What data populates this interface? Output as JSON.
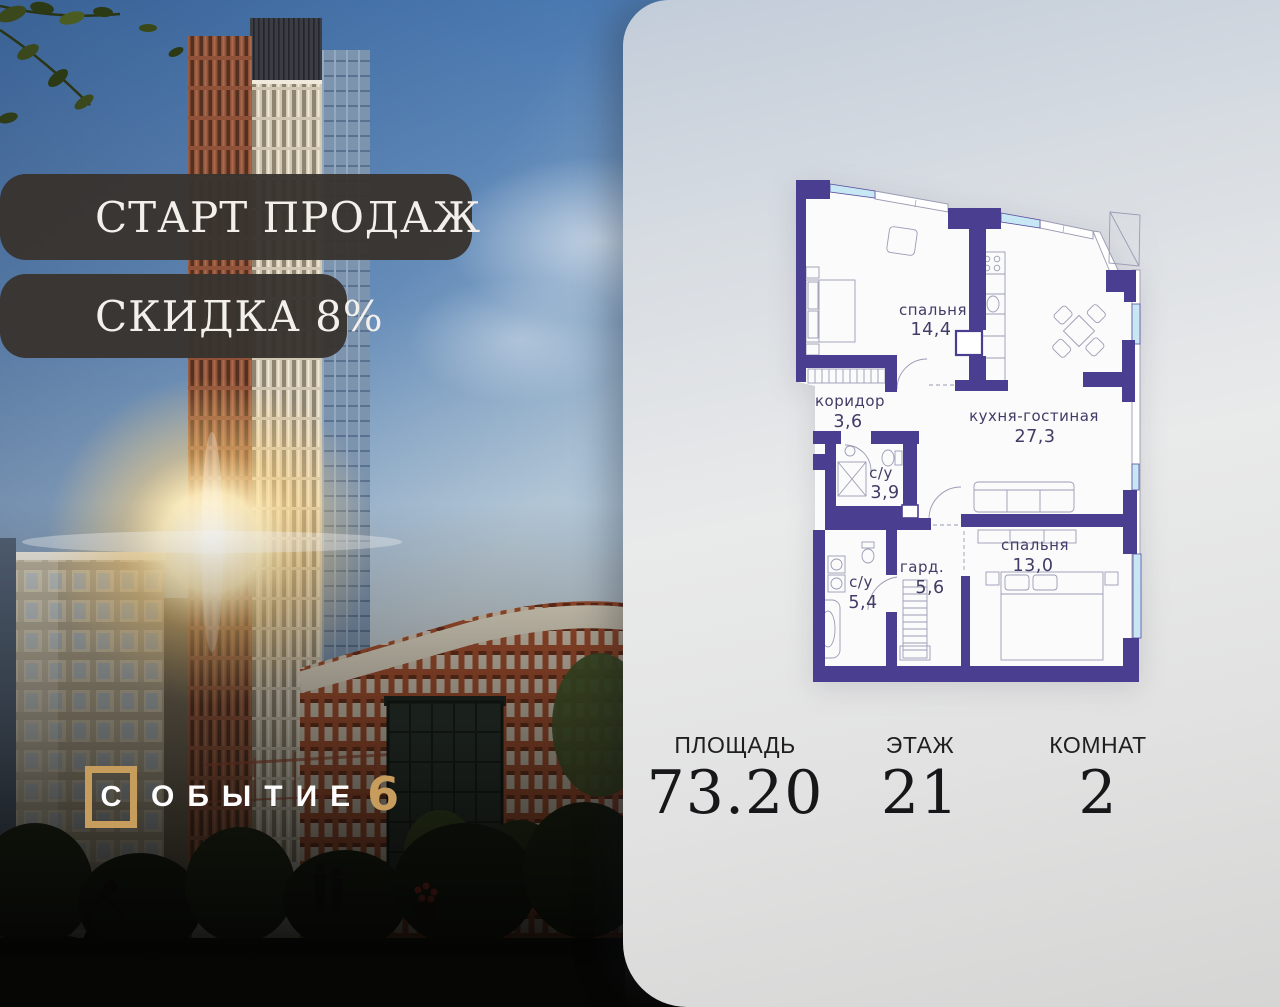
{
  "promo": {
    "banner1": "СТАРТ ПРОДАЖ",
    "banner2": "СКИДКА 8%"
  },
  "logo": {
    "letter_boxed": "С",
    "rest": "ОБЫТИЕ",
    "number": "6"
  },
  "plan": {
    "rooms": [
      {
        "name": "спальня",
        "area": "14,4"
      },
      {
        "name": "коридор",
        "area": "3,6"
      },
      {
        "name": "кухня-гостиная",
        "area": "27,3"
      },
      {
        "name": "с/у",
        "area": "3,9"
      },
      {
        "name": "с/у",
        "area": "5,4"
      },
      {
        "name": "гард.",
        "area": "5,6"
      },
      {
        "name": "спальня",
        "area": "13,0"
      }
    ]
  },
  "stats": [
    {
      "label": "ПЛОЩАДЬ",
      "value": "73.20"
    },
    {
      "label": "ЭТАЖ",
      "value": "21"
    },
    {
      "label": "КОМНАТ",
      "value": "2"
    }
  ],
  "colors": {
    "wall_indigo": "#4a3e90",
    "window_blue": "#c7e7f4",
    "accent_gold": "#c79d5e",
    "banner_bg": "#38332f",
    "panel_top": "#c2ccd9",
    "panel_bottom": "#d5d5d4"
  }
}
